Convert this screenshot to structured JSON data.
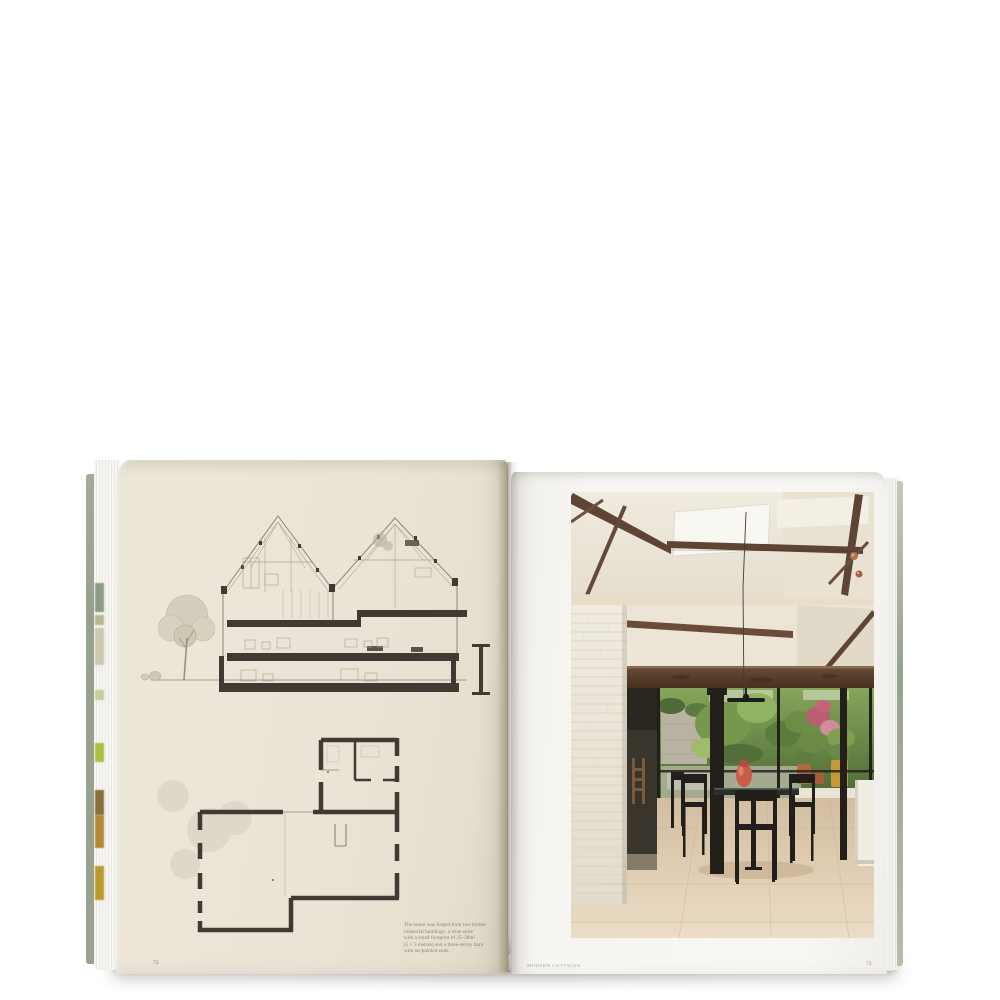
{
  "scene": {
    "subject": "Open hardcover architecture book photographed on a white backdrop",
    "left_page_content": "Hand-drawn cross-section of a twin-gabled house with trees, and a ground-floor plan",
    "right_page_content": "Photograph of a dining space under a pitched beamed ceiling with a glazed wall onto a garden"
  },
  "book": {
    "left_page": {
      "page_number": "72",
      "caption_lines": [
        "The house was forged from two former",
        "industrial buildings: a wine store",
        "with a small footprint of 25–28m²",
        "(5 × 5 metres) and a three-storey barn",
        "with tar-painted ends."
      ]
    },
    "right_page": {
      "running_footer": "Modern Cottages",
      "page_number": "73"
    }
  },
  "colors": {
    "background": "#ffffff",
    "cover-sage": "#96a18c",
    "paper-left": "#ebe4d6",
    "paper-right": "#f6f5f2",
    "caption-text": "#8a7e6e",
    "drawing-ink": "#3f3b33",
    "beam-brown": "#5e4434",
    "garden-green": "#6e8f49",
    "floor-travertine": "#dcc9ad",
    "vase-coral": "#c85c49",
    "pot-terracotta": "#b06a3e",
    "pot-mustard": "#c59a33",
    "frame-black": "#23201c",
    "brick-white": "#eee9de"
  }
}
